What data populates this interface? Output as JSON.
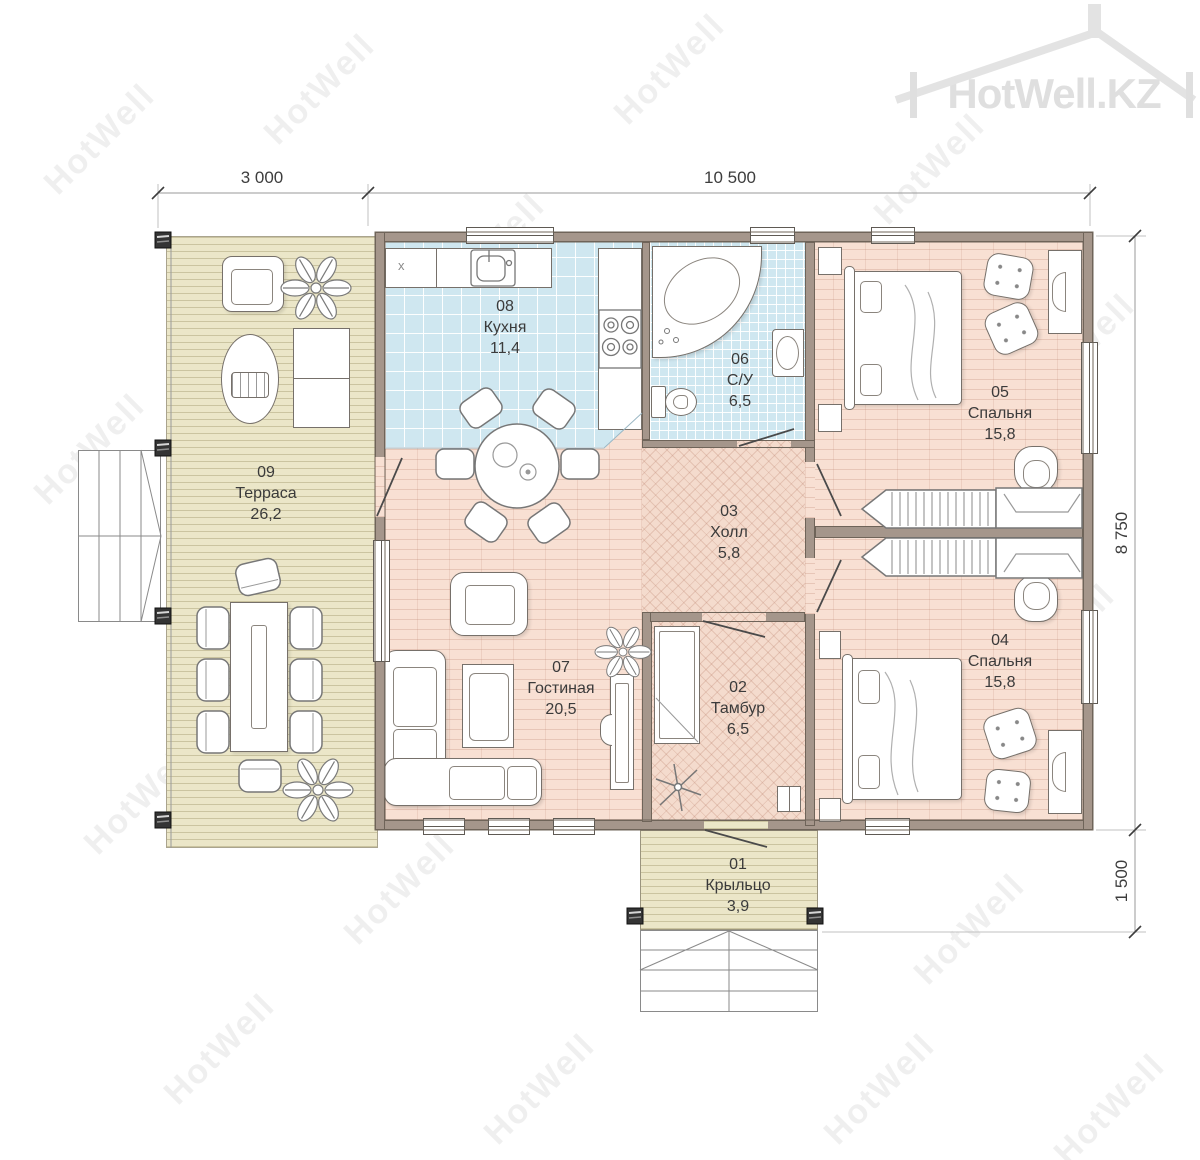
{
  "logo": {
    "text": "HotWell.KZ"
  },
  "watermark": {
    "text": "HotWell"
  },
  "dimensions": {
    "top_left": "3 000",
    "top_right": "10 500",
    "right_upper": "8 750",
    "right_lower": "1 500"
  },
  "rooms": [
    {
      "number": "01",
      "name": "Крыльцо",
      "area": "3,9"
    },
    {
      "number": "02",
      "name": "Тамбур",
      "area": "6,5"
    },
    {
      "number": "03",
      "name": "Холл",
      "area": "5,8"
    },
    {
      "number": "04",
      "name": "Спальня",
      "area": "15,8"
    },
    {
      "number": "05",
      "name": "Спальня",
      "area": "15,8"
    },
    {
      "number": "06",
      "name": "С/У",
      "area": "6,5"
    },
    {
      "number": "07",
      "name": "Гостиная",
      "area": "20,5"
    },
    {
      "number": "08",
      "name": "Кухня",
      "area": "11,4"
    },
    {
      "number": "09",
      "name": "Терраса",
      "area": "26,2"
    }
  ],
  "kitchen": {
    "cabinet_label": "x"
  },
  "colors": {
    "wall": "#a5968b",
    "tile": "#cfe7f0",
    "wood_deck": "#ebe6c8",
    "floor_pink": "#f8e0d3",
    "herringbone": "#f4dbcd",
    "label_text": "#3b3b3b",
    "logo_gray": "#dfdfdf"
  }
}
